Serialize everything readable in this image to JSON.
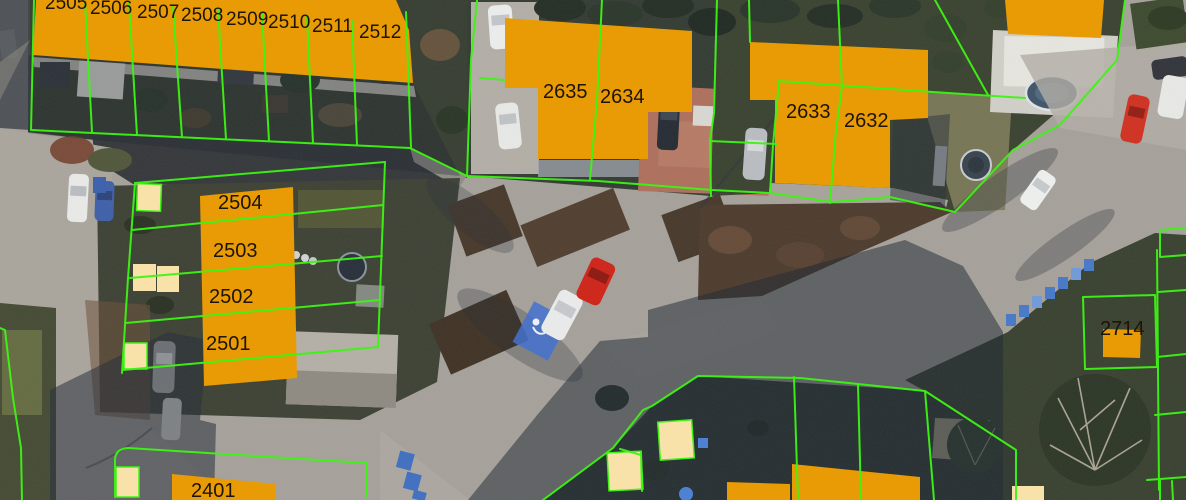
{
  "map": {
    "type": "aerial-orthophoto-with-cadastral-overlay",
    "overlay_colors": {
      "building_fill": "#E89B05",
      "shed_fill": "#F8E2A9",
      "boundary_green": "#3DF513",
      "label_color": "#1d1405"
    },
    "parcel_labels": [
      {
        "text": "2505",
        "x": 45,
        "y": 9
      },
      {
        "text": "2506",
        "x": 90,
        "y": 14
      },
      {
        "text": "2507",
        "x": 137,
        "y": 18
      },
      {
        "text": "2508",
        "x": 181,
        "y": 21
      },
      {
        "text": "2509",
        "x": 226,
        "y": 25
      },
      {
        "text": "2510",
        "x": 268,
        "y": 28
      },
      {
        "text": "2511",
        "x": 312,
        "y": 32
      },
      {
        "text": "2512",
        "x": 359,
        "y": 38
      },
      {
        "text": "2635",
        "x": 543,
        "y": 98
      },
      {
        "text": "2634",
        "x": 600,
        "y": 103
      },
      {
        "text": "2633",
        "x": 786,
        "y": 118
      },
      {
        "text": "2632",
        "x": 844,
        "y": 127
      },
      {
        "text": "2504",
        "x": 218,
        "y": 209
      },
      {
        "text": "2503",
        "x": 213,
        "y": 257
      },
      {
        "text": "2502",
        "x": 209,
        "y": 303
      },
      {
        "text": "2501",
        "x": 206,
        "y": 350
      },
      {
        "text": "2714",
        "x": 1100,
        "y": 335
      },
      {
        "text": "2401",
        "x": 191,
        "y": 497
      }
    ]
  }
}
